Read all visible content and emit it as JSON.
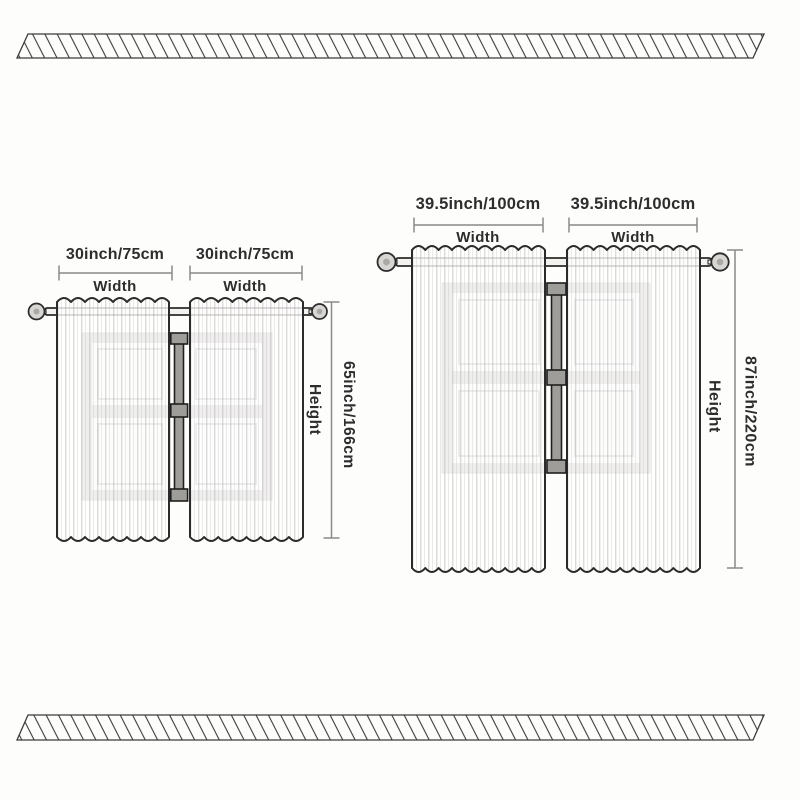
{
  "background": "#fdfdfb",
  "colors": {
    "text": "#2d2d2d",
    "outline": "#2b2b2b",
    "dim_line": "#8a8a8a",
    "hatch_stripe": "#3c3c3c",
    "window_frame": "#b2b1ae",
    "window_mullion": "#9e9d9a",
    "curtain_fill": "#f8f7f4",
    "finial_fill": "#d7d6d3"
  },
  "diagrams": {
    "small": {
      "panels": [
        {
          "width_label": "30inch/75cm",
          "width_caption": "Width"
        },
        {
          "width_label": "30inch/75cm",
          "width_caption": "Width"
        }
      ],
      "height_label": "65inch/166cm",
      "height_caption": "Height"
    },
    "large": {
      "panels": [
        {
          "width_label": "39.5inch/100cm",
          "width_caption": "Width"
        },
        {
          "width_label": "39.5inch/100cm",
          "width_caption": "Width"
        }
      ],
      "height_label": "87inch/220cm",
      "height_caption": "Height"
    }
  }
}
